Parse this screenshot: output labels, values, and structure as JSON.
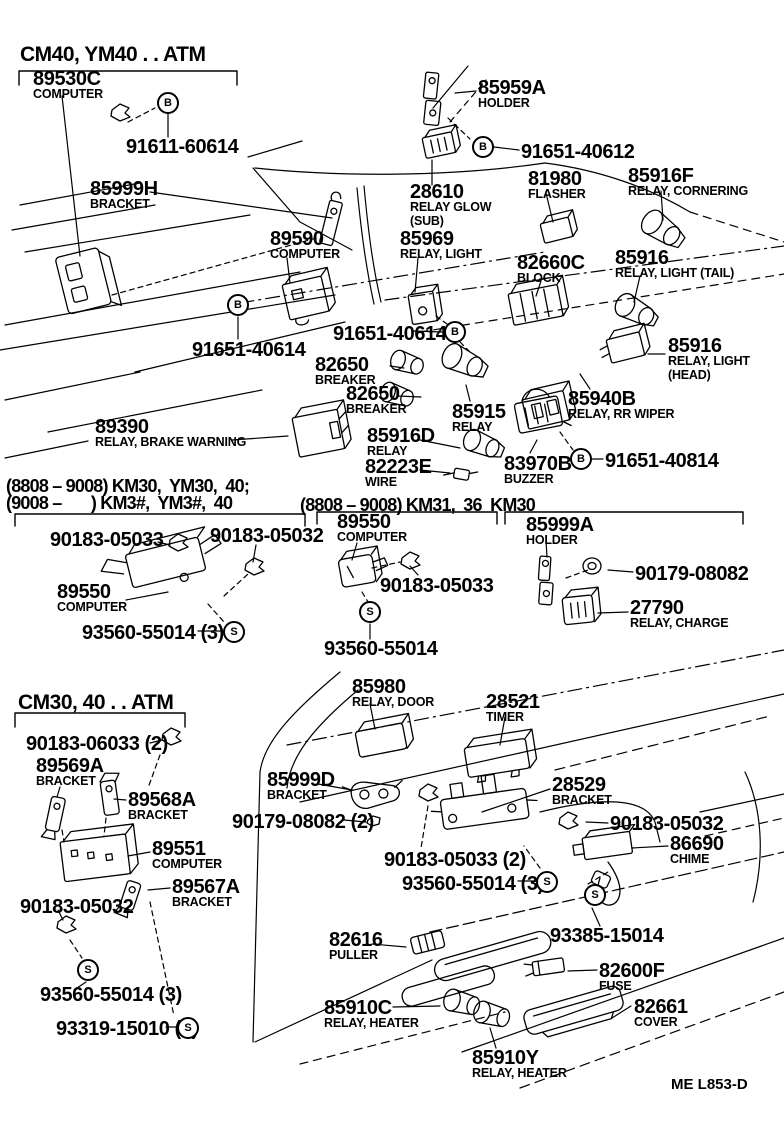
{
  "page": {
    "background": "#ffffff",
    "ink": "#000000"
  },
  "footer": {
    "drawing_code": "ME L853-D"
  },
  "labels": [
    {
      "name": "section-header-cm40-atm",
      "cls": "h1",
      "x": 20,
      "y": 44,
      "lines": [
        "CM40, YM40 . . ATM"
      ]
    },
    {
      "name": "part-89530c",
      "x": 33,
      "y": 70,
      "lines": [
        "89530C",
        "COMPUTER"
      ]
    },
    {
      "name": "part-91611-60614",
      "x": 126,
      "y": 138,
      "lines": [
        "91611-60614"
      ]
    },
    {
      "name": "part-85999h",
      "x": 90,
      "y": 180,
      "lines": [
        "85999H",
        "BRACKET"
      ]
    },
    {
      "name": "part-85959a",
      "x": 478,
      "y": 79,
      "lines": [
        "85959A",
        "HOLDER"
      ]
    },
    {
      "name": "part-91651-40612",
      "x": 521,
      "y": 143,
      "lines": [
        "91651-40612"
      ]
    },
    {
      "name": "part-28610",
      "x": 410,
      "y": 183,
      "lines": [
        "28610",
        "RELAY GLOW",
        "(SUB)"
      ]
    },
    {
      "name": "part-81980",
      "x": 528,
      "y": 170,
      "lines": [
        "81980",
        "FLASHER"
      ]
    },
    {
      "name": "part-85916f",
      "x": 628,
      "y": 167,
      "lines": [
        "85916F",
        "RELAY, CORNERING"
      ]
    },
    {
      "name": "part-89590",
      "x": 270,
      "y": 230,
      "lines": [
        "89590",
        "COMPUTER"
      ]
    },
    {
      "name": "part-85969",
      "x": 400,
      "y": 230,
      "lines": [
        "85969",
        "RELAY, LIGHT"
      ]
    },
    {
      "name": "part-82660c",
      "x": 517,
      "y": 254,
      "lines": [
        "82660C",
        "BLOCK"
      ]
    },
    {
      "name": "part-85916-tail",
      "x": 615,
      "y": 249,
      "lines": [
        "85916",
        "RELAY, LIGHT (TAIL)"
      ]
    },
    {
      "name": "part-91651-40614-a",
      "x": 333,
      "y": 325,
      "lines": [
        "91651-40614"
      ]
    },
    {
      "name": "part-91651-40614-b",
      "x": 192,
      "y": 341,
      "lines": [
        "91651-40614"
      ]
    },
    {
      "name": "part-82650-a",
      "x": 315,
      "y": 356,
      "lines": [
        "82650",
        "BREAKER"
      ]
    },
    {
      "name": "part-82650-b",
      "x": 346,
      "y": 385,
      "lines": [
        "82650",
        "BREAKER"
      ]
    },
    {
      "name": "part-85915",
      "x": 452,
      "y": 403,
      "lines": [
        "85915",
        "RELAY"
      ]
    },
    {
      "name": "part-85916-head",
      "x": 668,
      "y": 337,
      "lines": [
        "85916",
        "RELAY, LIGHT",
        "(HEAD)"
      ]
    },
    {
      "name": "part-85940b",
      "x": 568,
      "y": 390,
      "lines": [
        "85940B",
        "RELAY, RR WIPER"
      ]
    },
    {
      "name": "part-85916d",
      "x": 367,
      "y": 427,
      "lines": [
        "85916D",
        "RELAY"
      ]
    },
    {
      "name": "part-82223e",
      "x": 365,
      "y": 458,
      "lines": [
        "82223E",
        "WIRE"
      ]
    },
    {
      "name": "part-83970b",
      "x": 504,
      "y": 455,
      "lines": [
        "83970B",
        "BUZZER"
      ]
    },
    {
      "name": "part-91651-40814",
      "x": 605,
      "y": 452,
      "lines": [
        "91651-40814"
      ]
    },
    {
      "name": "part-89390",
      "x": 95,
      "y": 418,
      "lines": [
        "89390",
        "RELAY, BRAKE WARNING"
      ]
    },
    {
      "name": "section-header-km30-range1",
      "cls": "h2",
      "x": 6,
      "y": 477,
      "lines": [
        "(8808 – 9008) KM30,  YM30,  40;"
      ]
    },
    {
      "name": "section-header-km30-range2",
      "cls": "h2",
      "x": 6,
      "y": 494,
      "lines": [
        "(9008 –       ) KM3#,  YM3#,  40"
      ]
    },
    {
      "name": "section-header-km31",
      "cls": "h2",
      "x": 300,
      "y": 496,
      "lines": [
        "(8808 – 9008) KM31,  36  KM30"
      ]
    },
    {
      "name": "part-90183-05033-l",
      "x": 50,
      "y": 531,
      "lines": [
        "90183-05033"
      ]
    },
    {
      "name": "part-90183-05032-l",
      "x": 210,
      "y": 527,
      "lines": [
        "90183-05032"
      ]
    },
    {
      "name": "part-89550-left",
      "x": 57,
      "y": 583,
      "lines": [
        "89550",
        "COMPUTER"
      ]
    },
    {
      "name": "part-93560-55014-l",
      "x": 82,
      "y": 624,
      "lines": [
        "93560-55014 (3)"
      ]
    },
    {
      "name": "part-89550-mid",
      "x": 337,
      "y": 513,
      "lines": [
        "89550",
        "COMPUTER"
      ]
    },
    {
      "name": "part-90183-05033-m",
      "x": 380,
      "y": 577,
      "lines": [
        "90183-05033"
      ]
    },
    {
      "name": "part-93560-55014-m",
      "x": 324,
      "y": 640,
      "lines": [
        "93560-55014"
      ]
    },
    {
      "name": "part-85999a",
      "x": 526,
      "y": 516,
      "lines": [
        "85999A",
        "HOLDER"
      ]
    },
    {
      "name": "part-90179-08082",
      "x": 635,
      "y": 565,
      "lines": [
        "90179-08082"
      ]
    },
    {
      "name": "part-27790",
      "x": 630,
      "y": 599,
      "lines": [
        "27790",
        "RELAY, CHARGE"
      ]
    },
    {
      "name": "section-header-cm30-atm",
      "cls": "h1",
      "x": 18,
      "y": 692,
      "lines": [
        "CM30, 40 . . ATM"
      ]
    },
    {
      "name": "part-90183-06033",
      "x": 26,
      "y": 735,
      "lines": [
        "90183-06033 (2)"
      ]
    },
    {
      "name": "part-89569a",
      "x": 36,
      "y": 757,
      "lines": [
        "89569A",
        "BRACKET"
      ]
    },
    {
      "name": "part-89568a",
      "x": 128,
      "y": 791,
      "lines": [
        "89568A",
        "BRACKET"
      ]
    },
    {
      "name": "part-89551",
      "x": 152,
      "y": 840,
      "lines": [
        "89551",
        "COMPUTER"
      ]
    },
    {
      "name": "part-89567a",
      "x": 172,
      "y": 878,
      "lines": [
        "89567A",
        "BRACKET"
      ]
    },
    {
      "name": "part-90183-05032-bl",
      "x": 20,
      "y": 898,
      "lines": [
        "90183-05032"
      ]
    },
    {
      "name": "part-85980",
      "x": 352,
      "y": 678,
      "lines": [
        "85980",
        "RELAY, DOOR"
      ]
    },
    {
      "name": "part-28521",
      "x": 486,
      "y": 693,
      "lines": [
        "28521",
        "TIMER"
      ]
    },
    {
      "name": "part-85999d",
      "x": 267,
      "y": 771,
      "lines": [
        "85999D",
        "BRACKET"
      ]
    },
    {
      "name": "part-90179-08082-2",
      "x": 232,
      "y": 813,
      "lines": [
        "90179-08082 (2)"
      ]
    },
    {
      "name": "part-28529",
      "x": 552,
      "y": 776,
      "lines": [
        "28529",
        "BRACKET"
      ]
    },
    {
      "name": "part-90183-05032-m",
      "x": 610,
      "y": 815,
      "lines": [
        "90183-05032"
      ]
    },
    {
      "name": "part-86690",
      "x": 670,
      "y": 835,
      "lines": [
        "86690",
        "CHIME"
      ]
    },
    {
      "name": "part-90183-05033-2",
      "x": 384,
      "y": 851,
      "lines": [
        "90183-05033 (2)"
      ]
    },
    {
      "name": "part-93560-55014-3m",
      "x": 402,
      "y": 875,
      "lines": [
        "93560-55014 (3)"
      ]
    },
    {
      "name": "part-93385-15014",
      "x": 550,
      "y": 927,
      "lines": [
        "93385-15014"
      ]
    },
    {
      "name": "part-82616",
      "x": 329,
      "y": 931,
      "lines": [
        "82616",
        "PULLER"
      ]
    },
    {
      "name": "part-82600f",
      "x": 599,
      "y": 962,
      "lines": [
        "82600F",
        "FUSE"
      ]
    },
    {
      "name": "part-85910c",
      "x": 324,
      "y": 999,
      "lines": [
        "85910C",
        "RELAY, HEATER"
      ]
    },
    {
      "name": "part-82661",
      "x": 634,
      "y": 998,
      "lines": [
        "82661",
        "COVER"
      ]
    },
    {
      "name": "part-85910y",
      "x": 472,
      "y": 1049,
      "lines": [
        "85910Y",
        "RELAY, HEATER"
      ]
    },
    {
      "name": "part-93560-55014-bl",
      "x": 40,
      "y": 986,
      "lines": [
        "93560-55014 (3)"
      ]
    },
    {
      "name": "part-93319-15010",
      "x": 56,
      "y": 1020,
      "lines": [
        "93319-15010 (6)"
      ]
    },
    {
      "name": "drawing-code",
      "cls": "code",
      "x": 671,
      "y": 1077,
      "lines": [
        "ME L853-D"
      ]
    }
  ],
  "symbols": [
    {
      "name": "bolt-symbol-b1",
      "letter": "B",
      "x": 157,
      "y": 92
    },
    {
      "name": "bolt-symbol-b2",
      "letter": "B",
      "x": 472,
      "y": 136
    },
    {
      "name": "bolt-symbol-b3",
      "letter": "B",
      "x": 227,
      "y": 294
    },
    {
      "name": "bolt-symbol-b4",
      "letter": "B",
      "x": 444,
      "y": 321
    },
    {
      "name": "bolt-symbol-b5",
      "letter": "B",
      "x": 570,
      "y": 448
    },
    {
      "name": "screw-symbol-s1",
      "letter": "S",
      "x": 223,
      "y": 621
    },
    {
      "name": "screw-symbol-s2",
      "letter": "S",
      "x": 359,
      "y": 601
    },
    {
      "name": "screw-symbol-s3",
      "letter": "S",
      "x": 536,
      "y": 871
    },
    {
      "name": "screw-symbol-s4",
      "letter": "S",
      "x": 584,
      "y": 884
    },
    {
      "name": "screw-symbol-s5",
      "letter": "S",
      "x": 77,
      "y": 959
    },
    {
      "name": "screw-symbol-s6",
      "letter": "S",
      "x": 177,
      "y": 1017
    }
  ]
}
